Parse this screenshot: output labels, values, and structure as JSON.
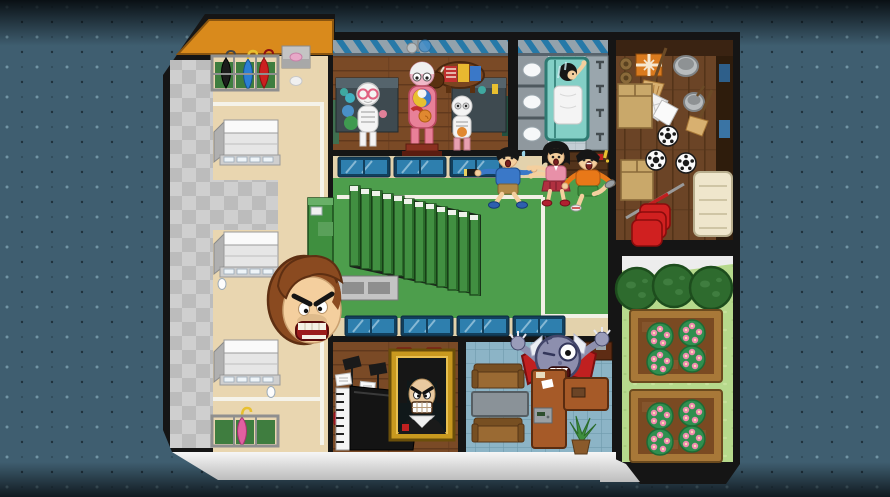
{
  "scene": {
    "name": "haunted-school-floorplan",
    "view": "top-down cartoon game map of a haunted school at night"
  },
  "palette": {
    "bg": "#3f5e70",
    "bgDeep": "#0a141a",
    "border": "#151515",
    "roof": "#d98a1c",
    "beige": "#e9d6b0",
    "tileA": "#cfcfcf",
    "tileB": "#bcbcbc",
    "lineWhite": "#f5f3ea",
    "cabinetFace": "#e6e6e6",
    "cabinetTop": "#fafafa",
    "cabinetSide": "#b0b0b0",
    "standGreen": "#3f7d3f",
    "frameGray": "#8f8f8f",
    "labWood": "#7a4a26",
    "labWoodDark": "#61391d",
    "stripeGray": "#93a2ac",
    "stripeBlue": "#2679a8",
    "wallShade": "#57636c",
    "deskSlate": "#3e4a50",
    "deskSlateTop": "#55646c",
    "bathTile": "#c3cdd4",
    "bathLine": "#a9b5bd",
    "stallGray": "#8f989e",
    "fixtureWhite": "#f6f8f9",
    "shower": "#83cfc6",
    "showerDark": "#2e7a72",
    "storageWood": "#6b4426",
    "storageLine": "#543419",
    "storageWall": "#3a2312",
    "shelfWood": "#2e1c0c",
    "hallTan": "#e3d2ac",
    "hallGreen": "#4d9e4c",
    "wallGreen": "#3f8f3f",
    "stepGreen": "#418f41",
    "stepCap": "#eef2ea",
    "stepDark": "#2a6b2a",
    "landing": "#c4c4c4",
    "landingDark": "#8e8e8e",
    "courtLine": "#f2f0e6",
    "officeTile": "#8cb4c6",
    "officeLine": "#6f9aac",
    "sofa": "#9a6a33",
    "sofaDark": "#774f22",
    "tableGray": "#8a9298",
    "deskBrown": "#a65a28",
    "monsterSkin": "#8d8fae",
    "monsterDark": "#43466a",
    "cape": "#c02020",
    "grass": "#b6d98c",
    "grassDot": "#c6e29c",
    "tree": "#2e6b2e",
    "treeDark": "#1d4d1d",
    "treeSpot": "#3f7d3f",
    "soil": "#7a4a22",
    "bedWood": "#a87838",
    "flowerBush": "#2f8f4f",
    "flowerPink": "#f08cb0",
    "flowerCenter": "#f8e2b2",
    "skin": "#f4cf9e",
    "hairBlack": "#161616",
    "hairBrown": "#8a4a20",
    "hairBrownDark": "#5e2f12",
    "blueShirt": "#3a78c8",
    "khaki": "#b08948",
    "pinkTop": "#e890a8",
    "redSkirt": "#b03040",
    "orangeShirt": "#e87818",
    "greenShorts": "#3f8f3f",
    "gold": "#c8991f",
    "goldLight": "#e8c050",
    "chairRed": "#c01828",
    "blueDesk": "#2e7fae",
    "blueDeskDark": "#123f5c",
    "cardboard": "#c9a86a",
    "bucketGray": "#b8bcbe",
    "coneRed": "#d02020",
    "matCream": "#efe6cc",
    "gift": "#d97a1e"
  },
  "rooms": [
    {
      "id": "entrance-hall",
      "features": [
        "checker-tile-genkan",
        "shoe-cabinets",
        "umbrella-stands",
        "white-floor-line"
      ]
    },
    {
      "id": "science-lab",
      "features": [
        "skeleton-model",
        "anatomy-model",
        "baby-anatomy-model",
        "cow-anatomy-model",
        "lab-desks"
      ]
    },
    {
      "id": "bathroom",
      "features": [
        "toilet-stalls",
        "sink-counter",
        "shower-stall"
      ]
    },
    {
      "id": "storage-room",
      "features": [
        "brooms",
        "buckets",
        "kites",
        "soccer-balls",
        "cardboard-boxes",
        "gift-box",
        "cones",
        "javelin",
        "vault-mat",
        "shelves"
      ]
    },
    {
      "id": "stairwell-hall",
      "features": [
        "descending-staircase",
        "floor-landing",
        "court-lines",
        "blue-desks"
      ]
    },
    {
      "id": "music-room",
      "features": [
        "grand-piano",
        "music-stands",
        "sheet-music",
        "red-chairs",
        "haunted-composer-portrait"
      ]
    },
    {
      "id": "principals-office",
      "features": [
        "sofas",
        "coffee-table",
        "office-desk",
        "safe",
        "potted-plant"
      ]
    },
    {
      "id": "garden",
      "features": [
        "hedge-trees",
        "flower-beds"
      ]
    }
  ],
  "characters": [
    {
      "id": "giant-angry-head",
      "desc": "huge floating angry face with brown hair"
    },
    {
      "id": "kid-boy-blue",
      "desc": "scared boy in blue sweater holding a flashlight"
    },
    {
      "id": "kid-girl-pink",
      "desc": "scared girl in pink top and red skirt"
    },
    {
      "id": "kid-boy-orange",
      "desc": "scared boy in orange shirt and green shorts"
    },
    {
      "id": "shower-ghost-girl",
      "desc": "black-haired girl in the shower stall"
    },
    {
      "id": "portrait-ghost",
      "desc": "grinning composer portrait in a gold frame"
    },
    {
      "id": "one-eyed-monster",
      "desc": "cyclops monster with raised claws behind the office desk"
    }
  ]
}
